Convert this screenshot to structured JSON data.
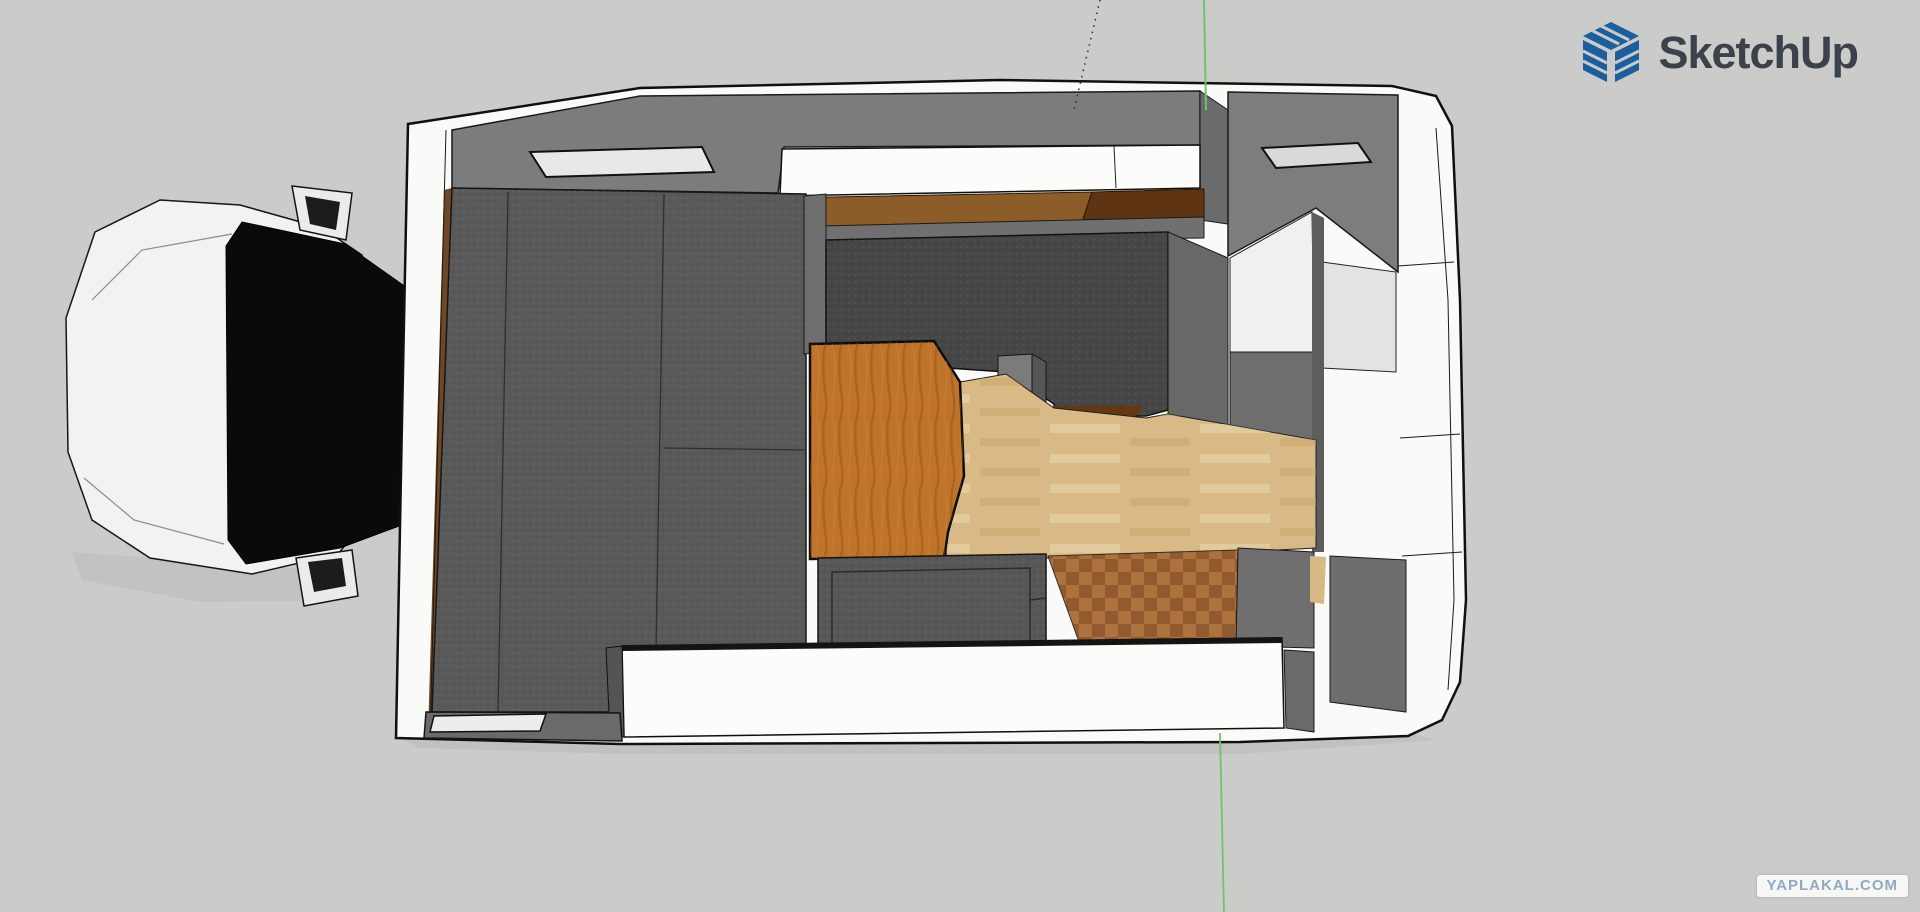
{
  "app": {
    "brand": "SketchUp",
    "brand_color": "#3b424b",
    "logo_blue": "#1b5f9e"
  },
  "watermark": {
    "text": "YAPLAKAL.COM",
    "color": "#91aac3",
    "bg": "#f7f7f6"
  },
  "canvas": {
    "bg": "#cbcbc9",
    "axis_green": "#72c172",
    "axis_dashed": "#33333d",
    "description": "top-down view of truck camper 3d model"
  },
  "scene": {
    "shapes": [
      {
        "name": "cab-shadow",
        "tag": "polygon",
        "interactable": false,
        "attrs": {
          "points": "72,552 340,572 352,600 200,602 82,580",
          "fill": "#bdbcba",
          "opacity": "0.55"
        }
      },
      {
        "name": "truck-cab-hood",
        "tag": "polygon",
        "interactable": true,
        "attrs": {
          "points": "95,232 160,200 240,205 322,228 362,255 366,300 366,520 338,554 252,574 150,558 92,520 68,452 66,318",
          "fill": "#f2f2f1",
          "stroke": "#161616",
          "stroke-width": "1.5"
        }
      },
      {
        "name": "truck-windshield",
        "tag": "polygon",
        "interactable": true,
        "attrs": {
          "points": "242,222 345,244 410,290 410,522 340,548 246,564 228,540 226,246",
          "fill": "#0a0a0a",
          "stroke": "#000000",
          "stroke-width": "1"
        }
      },
      {
        "name": "hood-crease-top",
        "tag": "polyline",
        "interactable": false,
        "attrs": {
          "points": "92,300 142,250 232,234",
          "fill": "none",
          "stroke": "#8c8c8a",
          "stroke-width": "1.2"
        }
      },
      {
        "name": "hood-crease-bottom",
        "tag": "polyline",
        "interactable": false,
        "attrs": {
          "points": "84,478 134,520 224,544",
          "fill": "none",
          "stroke": "#8c8c8a",
          "stroke-width": "1.2"
        }
      },
      {
        "name": "truck-mirror-top",
        "tag": "polygon",
        "interactable": true,
        "attrs": {
          "points": "292,186 352,193 346,240 300,230",
          "fill": "#ebebea",
          "stroke": "#141414",
          "stroke-width": "1.5"
        }
      },
      {
        "name": "truck-mirror-top-glass",
        "tag": "polygon",
        "interactable": false,
        "attrs": {
          "points": "305,196 340,202 336,230 310,224",
          "fill": "#1c1c1c"
        }
      },
      {
        "name": "truck-mirror-bottom",
        "tag": "polygon",
        "interactable": true,
        "attrs": {
          "points": "296,558 352,550 358,596 304,606",
          "fill": "#ebebea",
          "stroke": "#141414",
          "stroke-width": "1.5"
        }
      },
      {
        "name": "truck-mirror-bottom-glass",
        "tag": "polygon",
        "interactable": false,
        "attrs": {
          "points": "308,562 342,558 346,586 314,592",
          "fill": "#1c1c1c"
        }
      },
      {
        "name": "camper-ground-shadow",
        "tag": "polygon",
        "interactable": false,
        "attrs": {
          "points": "400,738 1240,742 1412,734 1436,740 1240,754 620,754 420,748",
          "fill": "#bdbcba",
          "opacity": "0.7"
        }
      },
      {
        "name": "camper-shell",
        "tag": "polygon",
        "interactable": true,
        "attrs": {
          "points": "408,124 640,88 1000,80 1392,86 1436,96 1452,126 1460,300 1466,600 1460,682 1442,720 1408,736 1240,742 620,744 396,738 402,420",
          "fill": "#fafaf9",
          "stroke": "#101010",
          "stroke-width": "2.5"
        }
      },
      {
        "name": "front-wall-wood-edge",
        "tag": "polygon",
        "interactable": true,
        "attrs": {
          "points": "444,190 452,188 436,736 428,734",
          "fill": "#6f4726"
        }
      },
      {
        "name": "front-wall-outline",
        "tag": "polyline",
        "interactable": false,
        "attrs": {
          "points": "446,130 430,737",
          "fill": "none",
          "stroke": "#1a1a1a",
          "stroke-width": "1"
        }
      },
      {
        "name": "top-wall",
        "tag": "polygon",
        "interactable": true,
        "attrs": {
          "points": "452,130 640,96 1200,91 1200,145 784,147 778,193 452,188",
          "fill": "#7c7c7c",
          "stroke": "#1a1a1a",
          "stroke-width": "1.5"
        }
      },
      {
        "name": "window-front-left",
        "tag": "polygon",
        "interactable": true,
        "attrs": {
          "points": "530,152 702,147 714,172 546,177",
          "fill": "#e8e8e7",
          "stroke": "#101010",
          "stroke-width": "2"
        }
      },
      {
        "name": "wall-column-mid",
        "tag": "polygon",
        "interactable": true,
        "attrs": {
          "points": "1200,91 1228,110 1228,224 1200,220",
          "fill": "#6b6b6b",
          "stroke": "#1a1a1a",
          "stroke-width": "1"
        }
      },
      {
        "name": "top-right-wall",
        "tag": "polygon",
        "interactable": true,
        "attrs": {
          "points": "1228,92 1398,95 1398,272 1316,208 1228,256",
          "fill": "#7d7d7d",
          "stroke": "#1a1a1a",
          "stroke-width": "1.5"
        }
      },
      {
        "name": "window-top-right",
        "tag": "polygon",
        "interactable": true,
        "attrs": {
          "points": "1262,148 1358,143 1371,162 1276,168",
          "fill": "#d9d9d8",
          "stroke": "#101010",
          "stroke-width": "2"
        }
      },
      {
        "name": "bathroom-floor",
        "tag": "polygon",
        "interactable": true,
        "attrs": {
          "points": "1230,258 1312,212 1314,352 1230,352",
          "fill": "#f0f0ef",
          "stroke": "#222222",
          "stroke-width": "1"
        }
      },
      {
        "name": "shower-panel",
        "tag": "polygon",
        "interactable": true,
        "attrs": {
          "points": "1322,262 1396,272 1396,372 1322,368",
          "fill": "#e3e3e2",
          "stroke": "#222222",
          "stroke-width": "1"
        }
      },
      {
        "name": "bathroom-wall-mid",
        "tag": "polygon",
        "interactable": true,
        "attrs": {
          "points": "1230,352 1314,352 1314,440 1230,440",
          "fill": "#6e6e6e",
          "stroke": "#1a1a1a",
          "stroke-width": "1"
        }
      },
      {
        "name": "bathroom-divider-wall",
        "tag": "polygon",
        "interactable": true,
        "attrs": {
          "points": "1312,212 1324,218 1324,552 1312,552",
          "fill": "#5d5d5d"
        }
      },
      {
        "name": "overhead-counter",
        "tag": "polygon",
        "interactable": true,
        "attrs": {
          "points": "782,149 1200,145 1200,188 780,196",
          "fill": "#fcfcfb",
          "stroke": "#101010",
          "stroke-width": "1.5"
        }
      },
      {
        "name": "overhead-counter-seam",
        "tag": "line",
        "interactable": false,
        "attrs": {
          "x1": "1114",
          "y1": "146",
          "x2": "1116",
          "y2": "188",
          "stroke": "#222222",
          "stroke-width": "1"
        }
      },
      {
        "name": "wood-shelf-left",
        "tag": "polygon",
        "interactable": true,
        "attrs": {
          "points": "780,198 1092,192 1082,222 778,227",
          "fill": "#8c5c29",
          "stroke": "#2a1708",
          "stroke-width": "1"
        }
      },
      {
        "name": "wood-shelf-right",
        "tag": "polygon",
        "interactable": true,
        "attrs": {
          "points": "1092,192 1204,189 1204,217 1082,222",
          "fill": "#5e3413",
          "stroke": "#2a1708",
          "stroke-width": "1"
        }
      },
      {
        "name": "kitchen-top-wall",
        "tag": "polygon",
        "interactable": true,
        "attrs": {
          "points": "778,227 1204,217 1204,238 778,242",
          "fill": "#707070",
          "stroke": "#1a1a1a",
          "stroke-width": "1"
        }
      },
      {
        "name": "bed-mattress",
        "tag": "polygon",
        "interactable": true,
        "attrs": {
          "points": "452,188 806,194 806,650 620,650 620,712 432,712",
          "fill": "#585958",
          "stroke": "#161616",
          "stroke-width": "1.5"
        }
      },
      {
        "name": "bed-mattress-texture",
        "tag": "polygon",
        "interactable": false,
        "attrs": {
          "points": "452,188 806,194 806,650 620,650 620,712 432,712",
          "fill": "url(#speckle)"
        }
      },
      {
        "name": "bed-seam-vertical-1",
        "tag": "line",
        "interactable": false,
        "attrs": {
          "x1": "508",
          "y1": "192",
          "x2": "498",
          "y2": "712",
          "stroke": "#2f2f2f",
          "stroke-width": "1.3"
        }
      },
      {
        "name": "bed-seam-vertical-2",
        "tag": "line",
        "interactable": false,
        "attrs": {
          "x1": "664",
          "y1": "194",
          "x2": "656",
          "y2": "650",
          "stroke": "#2f2f2f",
          "stroke-width": "1.3"
        }
      },
      {
        "name": "bed-seam-horizontal",
        "tag": "line",
        "interactable": false,
        "attrs": {
          "x1": "664",
          "y1": "448",
          "x2": "806",
          "y2": "450",
          "stroke": "#2f2f2f",
          "stroke-width": "1.3"
        }
      },
      {
        "name": "bed-kitchen-divider",
        "tag": "polygon",
        "interactable": true,
        "attrs": {
          "points": "804,196 826,194 826,352 804,354",
          "fill": "#6f6f6f",
          "stroke": "#1a1a1a",
          "stroke-width": "1"
        }
      },
      {
        "name": "kitchen-counter",
        "tag": "polygon",
        "interactable": true,
        "attrs": {
          "points": "826,240 1168,232 1168,410 1146,416 1054,416 1054,404 1006,372 948,368 934,342 826,346",
          "fill": "#454645",
          "stroke": "#101010",
          "stroke-width": "1.5"
        }
      },
      {
        "name": "kitchen-counter-texture",
        "tag": "polygon",
        "interactable": false,
        "attrs": {
          "points": "826,240 1168,232 1168,410 1146,416 1054,416 1054,404 1006,372 948,368 934,342 826,346",
          "fill": "url(#speckle)"
        }
      },
      {
        "name": "kitchen-counter-wood-edge",
        "tag": "polygon",
        "interactable": true,
        "attrs": {
          "points": "1054,406 1144,406 1132,420 1054,420",
          "fill": "#653812"
        }
      },
      {
        "name": "kitchen-box",
        "tag": "polygon",
        "interactable": true,
        "attrs": {
          "points": "998,356 1032,354 1032,420 998,422",
          "fill": "#7b7b7b",
          "stroke": "#141414",
          "stroke-width": "1"
        }
      },
      {
        "name": "kitchen-box-side",
        "tag": "polygon",
        "interactable": true,
        "attrs": {
          "points": "1032,354 1046,362 1046,414 1032,420",
          "fill": "#565656",
          "stroke": "#141414",
          "stroke-width": "1"
        }
      },
      {
        "name": "kitchen-right-wall",
        "tag": "polygon",
        "interactable": true,
        "attrs": {
          "points": "1168,232 1228,258 1228,440 1168,414",
          "fill": "#686868",
          "stroke": "#1a1a1a",
          "stroke-width": "1"
        }
      },
      {
        "name": "floor-light-wood",
        "tag": "polygon",
        "interactable": true,
        "attrs": {
          "points": "960,382 1006,374 1054,408 1146,418 1168,414 1316,440 1316,548 1240,552 1052,558 946,558 948,532 964,478",
          "fill": "#d9ba86",
          "stroke": "#1f1f1f",
          "stroke-width": "1"
        }
      },
      {
        "name": "floor-light-wood-texture",
        "tag": "polygon",
        "interactable": false,
        "attrs": {
          "points": "960,382 1006,374 1054,408 1146,418 1168,414 1316,440 1316,548 1240,552 1052,558 946,558 948,532 964,478",
          "fill": "url(#planks)"
        }
      },
      {
        "name": "dinette-table",
        "tag": "polygon",
        "interactable": true,
        "attrs": {
          "points": "810,344 934,341 960,382 964,476 948,532 944,558 810,559",
          "fill": "#bf742a",
          "stroke": "#0d0d0d",
          "stroke-width": "2.5"
        }
      },
      {
        "name": "dinette-table-grain",
        "tag": "polygon",
        "interactable": false,
        "attrs": {
          "points": "810,344 934,341 960,382 964,476 948,532 944,558 810,559",
          "fill": "url(#grain)"
        }
      },
      {
        "name": "bench-seat-gray",
        "tag": "polygon",
        "interactable": true,
        "attrs": {
          "points": "818,558 1046,554 1046,650 818,652",
          "fill": "#565756",
          "stroke": "#131313",
          "stroke-width": "1.5"
        }
      },
      {
        "name": "bench-seat-gray-texture",
        "tag": "polygon",
        "interactable": false,
        "attrs": {
          "points": "818,558 1046,554 1046,650 818,652",
          "fill": "url(#speckle)"
        }
      },
      {
        "name": "bench-seat-inner-outline",
        "tag": "polygon",
        "interactable": false,
        "attrs": {
          "points": "832,572 1030,568 1030,646 832,649",
          "fill": "none",
          "stroke": "#2b2b2b",
          "stroke-width": "1.5"
        }
      },
      {
        "name": "bench-seat-step-line",
        "tag": "line",
        "interactable": false,
        "attrs": {
          "x1": "1030",
          "y1": "600",
          "x2": "1046",
          "y2": "598",
          "stroke": "#2b2b2b",
          "stroke-width": "1.5"
        }
      },
      {
        "name": "entry-parquet-floor",
        "tag": "polygon",
        "interactable": true,
        "attrs": {
          "points": "1048,556 1238,550 1236,646 1082,650",
          "fill": "#a2683a",
          "stroke": "#1c1c1c",
          "stroke-width": "1"
        }
      },
      {
        "name": "entry-parquet-texture",
        "tag": "polygon",
        "interactable": false,
        "attrs": {
          "points": "1048,556 1238,550 1236,646 1082,650",
          "fill": "url(#parquet)"
        }
      },
      {
        "name": "entry-wall-upper",
        "tag": "polygon",
        "interactable": true,
        "attrs": {
          "points": "1238,548 1314,552 1314,648 1236,646",
          "fill": "#6f6f6f",
          "stroke": "#1a1a1a",
          "stroke-width": "1"
        }
      },
      {
        "name": "entry-floor-sliver",
        "tag": "polygon",
        "interactable": false,
        "attrs": {
          "points": "1310,556 1326,557 1324,604 1310,602",
          "fill": "#d7b985"
        }
      },
      {
        "name": "entry-gap-wall",
        "tag": "polygon",
        "interactable": true,
        "attrs": {
          "points": "1330,556 1406,560 1406,712 1330,702",
          "fill": "#6d6d6d",
          "stroke": "#1a1a1a",
          "stroke-width": "1"
        }
      },
      {
        "name": "entry-wall-lower",
        "tag": "polygon",
        "interactable": true,
        "attrs": {
          "points": "1284,650 1314,652 1314,732 1286,728",
          "fill": "#6a6a6a",
          "stroke": "#1a1a1a",
          "stroke-width": "1"
        }
      },
      {
        "name": "white-bench",
        "tag": "polygon",
        "interactable": true,
        "attrs": {
          "points": "622,646 1282,638 1284,728 624,737",
          "fill": "#fcfcfb",
          "stroke": "#101010",
          "stroke-width": "1.5"
        }
      },
      {
        "name": "white-bench-top-edge",
        "tag": "polyline",
        "interactable": false,
        "attrs": {
          "points": "622,648 1282,640",
          "fill": "none",
          "stroke": "#141414",
          "stroke-width": "6"
        }
      },
      {
        "name": "white-bench-end-cap",
        "tag": "polygon",
        "interactable": true,
        "attrs": {
          "points": "606,648 622,646 624,737 610,735",
          "fill": "#545454",
          "stroke": "#101010",
          "stroke-width": "1"
        }
      },
      {
        "name": "bottom-wall",
        "tag": "polygon",
        "interactable": true,
        "attrs": {
          "points": "426,712 620,713 622,741 424,738",
          "fill": "#6a6a6a",
          "stroke": "#151515",
          "stroke-width": "1.5"
        }
      },
      {
        "name": "window-bottom",
        "tag": "polygon",
        "interactable": true,
        "attrs": {
          "points": "434,716 546,714 540,731 430,732",
          "fill": "#ededec",
          "stroke": "#101010",
          "stroke-width": "1.5"
        }
      },
      {
        "name": "shell-inner-line",
        "tag": "polyline",
        "interactable": false,
        "attrs": {
          "points": "1436,128 1448,300 1454,600 1448,690",
          "fill": "none",
          "stroke": "#1a1a1a",
          "stroke-width": "1"
        }
      },
      {
        "name": "shell-seam-1",
        "tag": "line",
        "interactable": false,
        "attrs": {
          "x1": "1398",
          "y1": "266",
          "x2": "1454",
          "y2": "262",
          "stroke": "#1a1a1a",
          "stroke-width": "1"
        }
      },
      {
        "name": "shell-seam-2",
        "tag": "line",
        "interactable": false,
        "attrs": {
          "x1": "1400",
          "y1": "438",
          "x2": "1460",
          "y2": "434",
          "stroke": "#1a1a1a",
          "stroke-width": "1"
        }
      },
      {
        "name": "shell-seam-3",
        "tag": "line",
        "interactable": false,
        "attrs": {
          "x1": "1402",
          "y1": "556",
          "x2": "1462",
          "y2": "552",
          "stroke": "#1a1a1a",
          "stroke-width": "1"
        }
      },
      {
        "name": "axis-dashed-line",
        "tag": "polyline",
        "interactable": false,
        "attrs": {
          "points": "1100,0 1074,110",
          "fill": "none",
          "stroke": "#33333d",
          "stroke-width": "1.6",
          "stroke-dasharray": "1.5 5"
        }
      },
      {
        "name": "axis-green-top",
        "tag": "line",
        "interactable": false,
        "attrs": {
          "x1": "1204",
          "y1": "0",
          "x2": "1206",
          "y2": "110",
          "stroke": "#72c172",
          "stroke-width": "2"
        }
      },
      {
        "name": "axis-green-bottom",
        "tag": "line",
        "interactable": false,
        "attrs": {
          "x1": "1220",
          "y1": "733",
          "x2": "1224",
          "y2": "912",
          "stroke": "#72c172",
          "stroke-width": "1.8"
        }
      }
    ]
  }
}
